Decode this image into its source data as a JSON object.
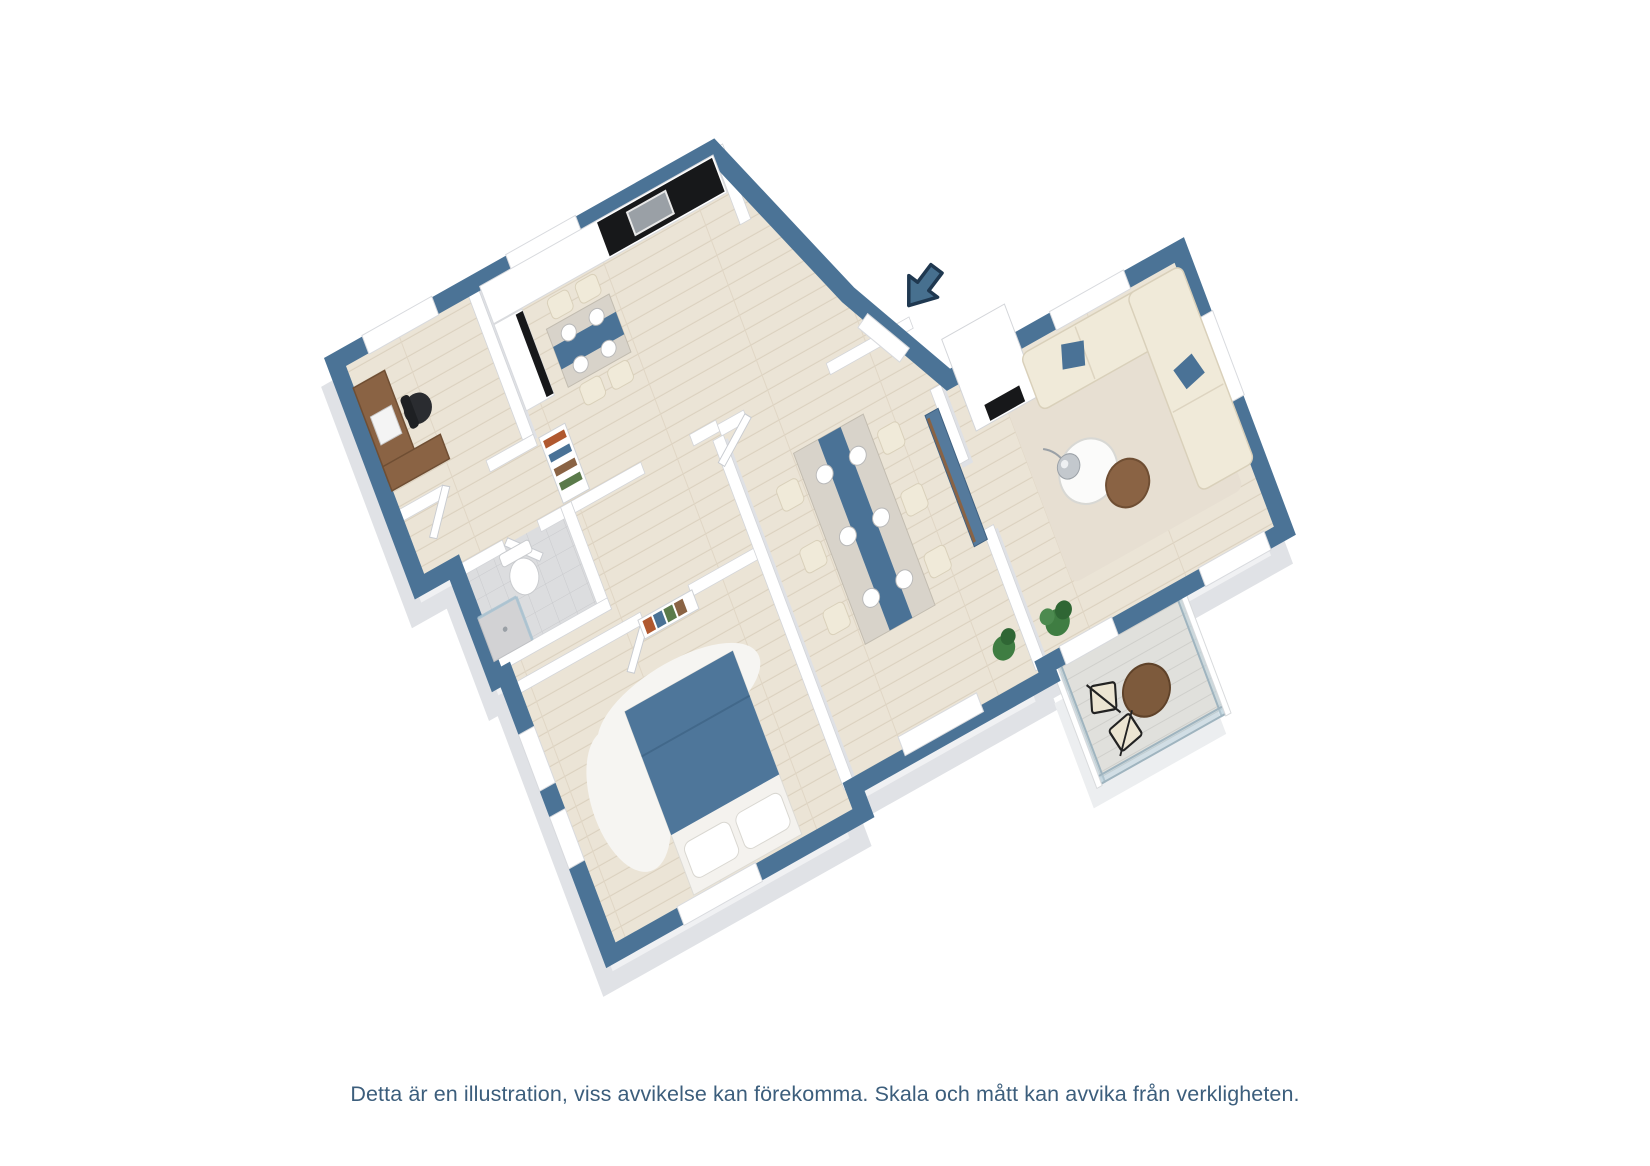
{
  "caption": {
    "text": "Detta är en illustration, viss avvikelse kan förekomma. Skala och mått kan avvika från verkligheten."
  },
  "markers": {
    "entrance_arrow": "entrance-arrow pointing to front door"
  },
  "palette": {
    "wall_top": "#4b7396",
    "wall_outline_dark": "#1f3850",
    "wall_extrusion": "#e7e8eb",
    "floor_wood": "#ebe4d6",
    "floor_plank_line": "#dbd1bf",
    "bathroom_tile": "#dcdddf",
    "balcony_deck": "#e0e0dc",
    "glass": "#bcd2dd",
    "furniture_cream": "#f0ead9",
    "furniture_wood": "#8a6344",
    "appliance_black": "#17181a",
    "textile_blue": "#4a7296",
    "caption_text": "#3c5e7c"
  },
  "rooms": [
    {
      "name": "office",
      "furniture": [
        "corner-desk",
        "office-chair",
        "laptop",
        "window"
      ]
    },
    {
      "name": "kitchen",
      "furniture": [
        "counter-run",
        "black-countertop",
        "sink",
        "tall-cabinet",
        "kitchen-table",
        "four-chairs",
        "window"
      ]
    },
    {
      "name": "entrance-hall",
      "furniture": [
        "front-door",
        "bookshelf"
      ]
    },
    {
      "name": "living-room",
      "furniture": [
        "fireplace",
        "l-shaped-sofa",
        "blue-pillows",
        "round-coffee-table",
        "wood-side-table",
        "floor-lamp",
        "rug",
        "plant",
        "windows"
      ]
    },
    {
      "name": "dining-room",
      "furniture": [
        "dining-table",
        "blue-runner",
        "six-chairs",
        "place-settings",
        "sideboard",
        "plant",
        "window"
      ]
    },
    {
      "name": "bedroom",
      "furniture": [
        "double-bed-blue-duvet",
        "pillows",
        "white-rug",
        "bookshelf",
        "windows"
      ]
    },
    {
      "name": "bathroom",
      "furniture": [
        "toilet",
        "shower",
        "glass-partition",
        "tile-floor"
      ]
    },
    {
      "name": "balcony",
      "furniture": [
        "glass-railing",
        "round-wood-table",
        "two-chairs",
        "deck"
      ]
    }
  ]
}
